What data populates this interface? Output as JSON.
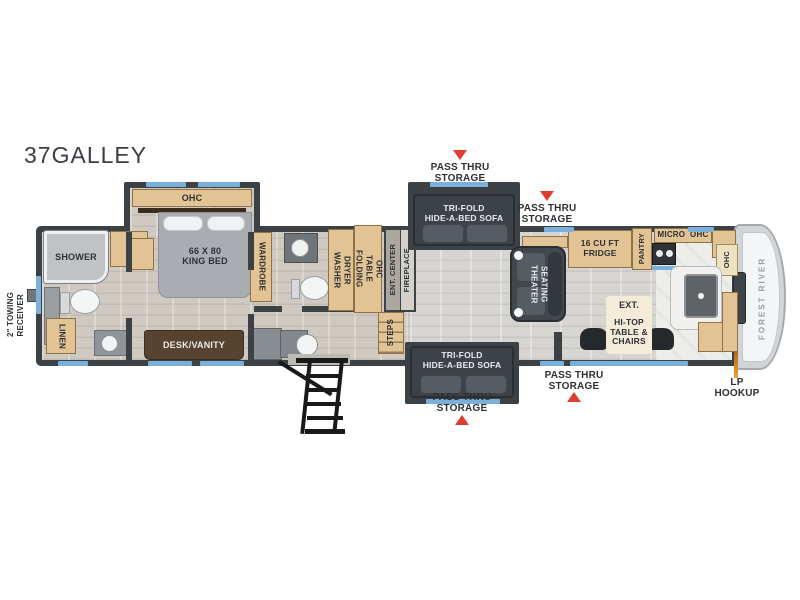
{
  "title": "37GALLEY",
  "brand": "FOREST RIVER",
  "labels": {
    "towing_l1": "2\" TOWING",
    "towing_l2": "RECEIVER",
    "shower": "SHOWER",
    "linen": "LINEN",
    "ohc": "OHC",
    "bed_l1": "66 X 80",
    "bed_l2": "KING BED",
    "wardrobe": "WARDROBE",
    "desk_vanity": "DESK/VANITY",
    "washer": "WASHER",
    "dryer": "DRYER",
    "folding_l1": "FOLDING",
    "folding_l2": "TABLE",
    "ent_center": "ENT. CENTER",
    "fireplace": "FIREPLACE",
    "steps": "STEPS",
    "sofa_l1": "TRI-FOLD",
    "sofa_l2": "HIDE-A-BED SOFA",
    "theater_l1": "THEATER",
    "theater_l2": "SEATING",
    "fridge_l1": "16 CU FT",
    "fridge_l2": "FRIDGE",
    "pantry": "PANTRY",
    "micro_ohc": "MICRO  OHC",
    "ext": "EXT.",
    "hitop_l1": "HI-TOP",
    "hitop_l2": "TABLE &",
    "hitop_l3": "CHAIRS",
    "pass_thru_l1": "PASS THRU",
    "pass_thru_l2": "STORAGE",
    "lp_l1": "LP",
    "lp_l2": "HOOKUP"
  },
  "colors": {
    "wall": "#3c4146",
    "cabinet_tan": "#e2c394",
    "window_blue": "#7ab1dc",
    "arrow_red": "#e23b30",
    "sofa_dark": "#3f444a",
    "floor_gray": "#d2cec8"
  }
}
